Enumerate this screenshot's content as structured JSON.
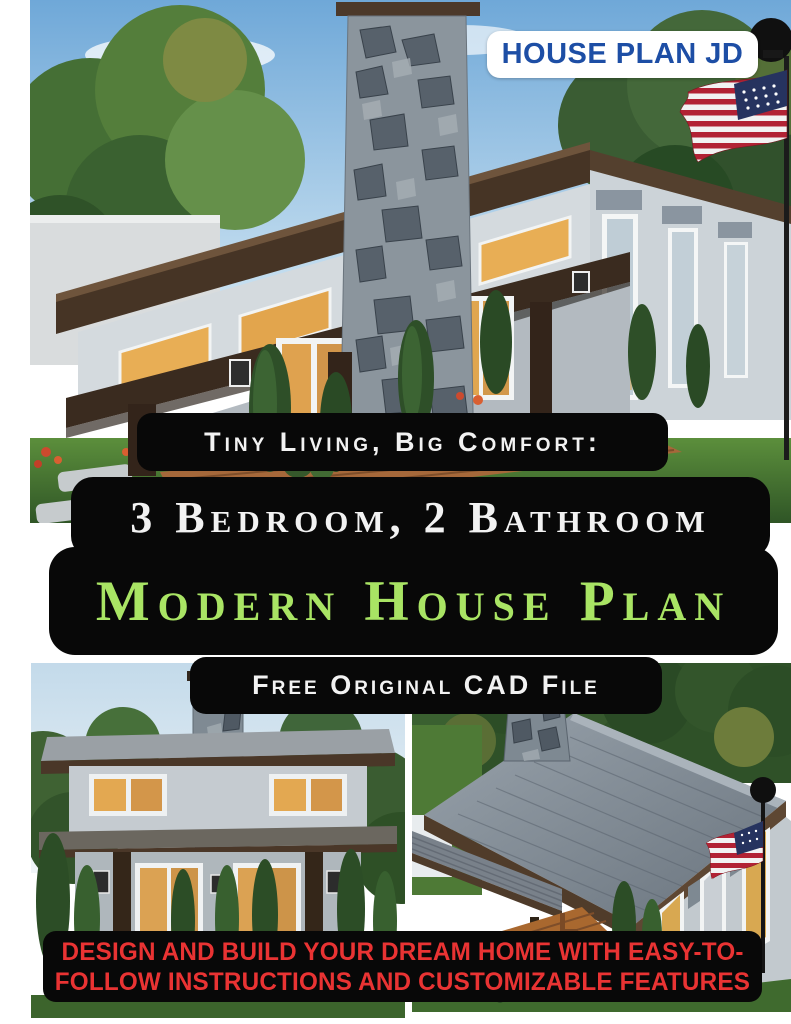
{
  "badge": {
    "label": "HOUSE PLAN JD"
  },
  "headline": {
    "kicker": "Tiny Living, Big Comfort:",
    "bedrooms": "3 Bedroom, 2 Bathroom",
    "title": "Modern House Plan",
    "sub": "Free Original CAD File"
  },
  "footer": {
    "line1": "DESIGN AND BUILD YOUR DREAM HOME WITH EASY-TO-",
    "line2": "FOLLOW INSTRUCTIONS AND CUSTOMIZABLE FEATURES"
  },
  "colors": {
    "badge-blue": "#1d4ea5",
    "band-black": "#080808",
    "headline-white": "#f2f2f2",
    "headline-green": "#a9e464",
    "footer-red": "#e93333"
  },
  "images": {
    "top": "modern house front render with stone chimney, porch and US flag",
    "bottom_left": "modern house front at dusk with lit doors",
    "bottom_right": "aerial view of modern house gray roof with US flag"
  }
}
